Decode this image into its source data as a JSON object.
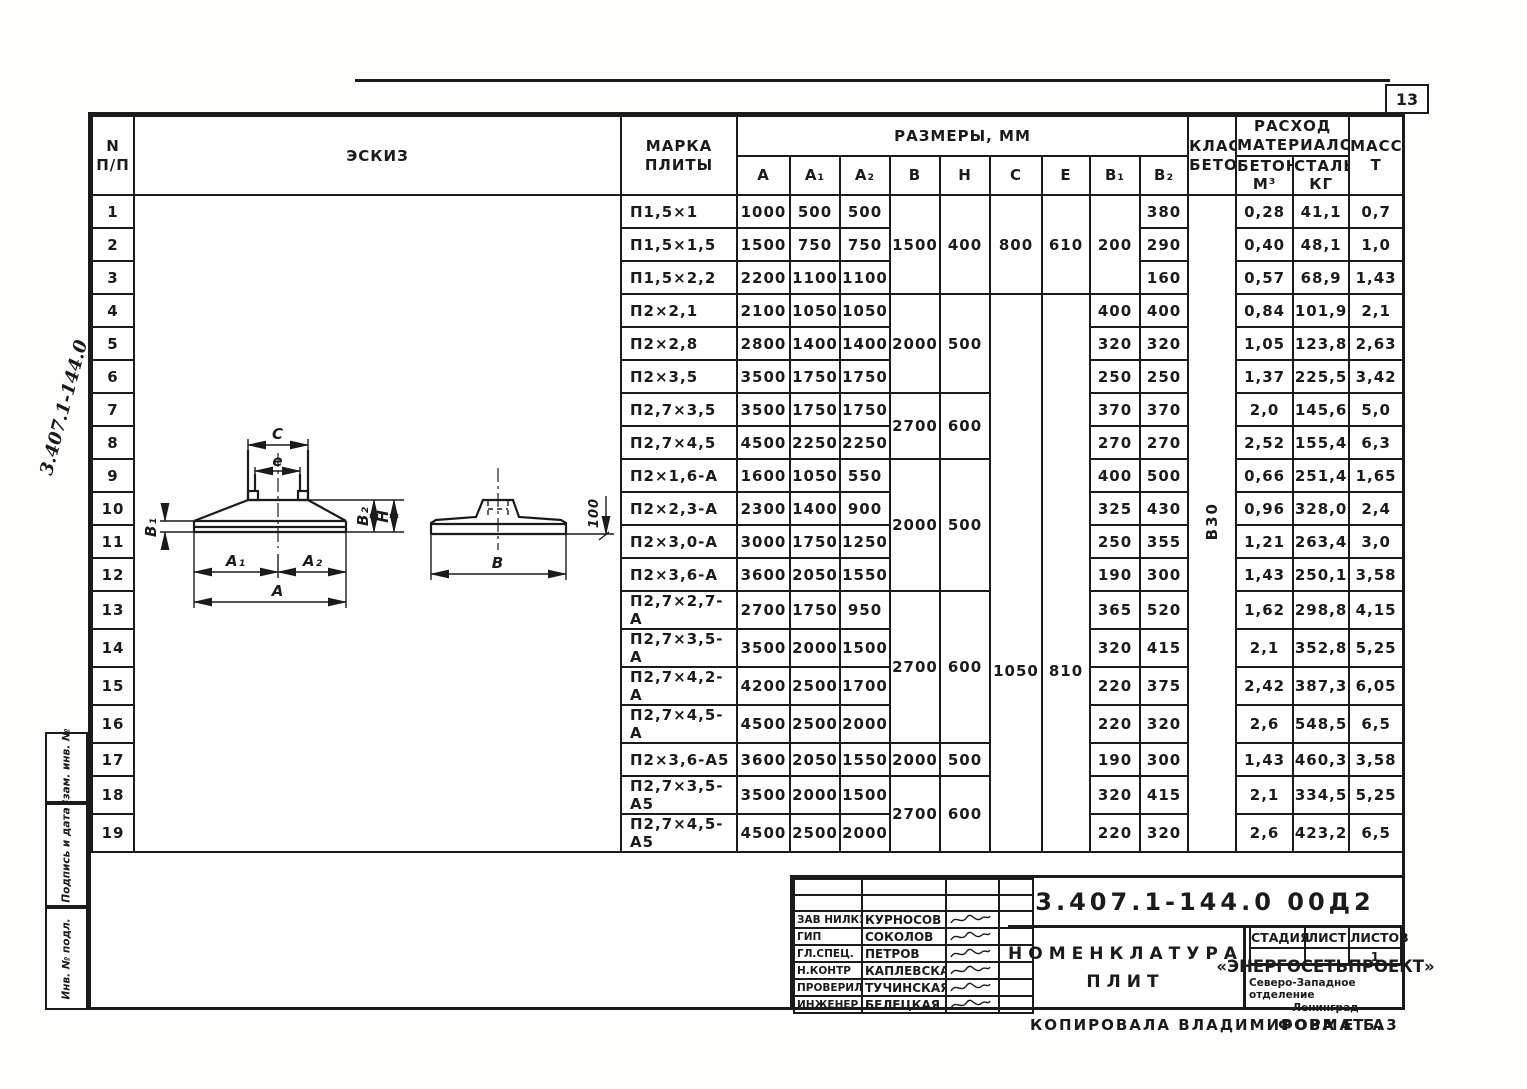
{
  "page_number": "13",
  "side_code": "3.407.1-144.0",
  "side_stamps": [
    "Взам. инв. №",
    "Подпись и дата",
    "Инв. № подл."
  ],
  "concrete_class": "В30",
  "table": {
    "headers": {
      "num": "N",
      "num2": "п/п",
      "sketch": "Эскиз",
      "mark": "Марка",
      "mark2": "плиты",
      "sizes": "Размеры, мм",
      "A": "А",
      "A1": "А₁",
      "A2": "А₂",
      "B": "В",
      "H": "Н",
      "C": "С",
      "e": "е",
      "B1": "В₁",
      "B2": "В₂",
      "cls": "Класс",
      "cls2": "бетона",
      "materials": "Расход",
      "materials2": "материалов",
      "concrete": "Бетон,",
      "concrete2": "м³",
      "steel": "Сталь,",
      "steel2": "кг",
      "mass": "Масса,",
      "mass2": "т"
    },
    "columns": [
      "num",
      "sk",
      "mark",
      "A",
      "A1",
      "A2",
      "B",
      "H",
      "C",
      "e",
      "B1",
      "B2",
      "cls",
      "concrete",
      "steel",
      "mass"
    ],
    "rows": [
      {
        "num": "1",
        "sk": {
          "slot": "sketch",
          "span": 19
        },
        "mark": "П1,5×1",
        "A": "1000",
        "A1": "500",
        "A2": "500",
        "B": {
          "v": "1500",
          "span": 3
        },
        "H": {
          "v": "400",
          "span": 3
        },
        "C": {
          "v": "800",
          "span": 3
        },
        "e": {
          "v": "610",
          "span": 3
        },
        "B1": {
          "v": "200",
          "span": 3
        },
        "B2": "380",
        "cls": {
          "v": "В30",
          "span": 19,
          "cls": "vert"
        },
        "concrete": "0,28",
        "steel": "41,1",
        "mass": "0,7"
      },
      {
        "num": "2",
        "mark": "П1,5×1,5",
        "A": "1500",
        "A1": "750",
        "A2": "750",
        "B2": "290",
        "concrete": "0,40",
        "steel": "48,1",
        "mass": "1,0"
      },
      {
        "num": "3",
        "mark": "П1,5×2,2",
        "A": "2200",
        "A1": "1100",
        "A2": "1100",
        "B2": "160",
        "concrete": "0,57",
        "steel": "68,9",
        "mass": "1,43"
      },
      {
        "num": "4",
        "mark": "П2×2,1",
        "A": "2100",
        "A1": "1050",
        "A2": "1050",
        "B": {
          "v": "2000",
          "span": 3
        },
        "H": {
          "v": "500",
          "span": 3
        },
        "C": {
          "v": "1050",
          "span": 16,
          "cls": "ce"
        },
        "e": {
          "v": "810",
          "span": 16,
          "cls": "ce"
        },
        "B1": "400",
        "B2": "400",
        "concrete": "0,84",
        "steel": "101,9",
        "mass": "2,1"
      },
      {
        "num": "5",
        "mark": "П2×2,8",
        "A": "2800",
        "A1": "1400",
        "A2": "1400",
        "B1": "320",
        "B2": "320",
        "concrete": "1,05",
        "steel": "123,8",
        "mass": "2,63"
      },
      {
        "num": "6",
        "mark": "П2×3,5",
        "A": "3500",
        "A1": "1750",
        "A2": "1750",
        "B1": "250",
        "B2": "250",
        "concrete": "1,37",
        "steel": "225,5",
        "mass": "3,42"
      },
      {
        "num": "7",
        "mark": "П2,7×3,5",
        "A": "3500",
        "A1": "1750",
        "A2": "1750",
        "B": {
          "v": "2700",
          "span": 2
        },
        "H": {
          "v": "600",
          "span": 2
        },
        "B1": "370",
        "B2": "370",
        "concrete": "2,0",
        "steel": "145,6",
        "mass": "5,0"
      },
      {
        "num": "8",
        "mark": "П2,7×4,5",
        "A": "4500",
        "A1": "2250",
        "A2": "2250",
        "B1": "270",
        "B2": "270",
        "concrete": "2,52",
        "steel": "155,4",
        "mass": "6,3"
      },
      {
        "num": "9",
        "mark": "П2×1,6-А",
        "A": "1600",
        "A1": "1050",
        "A2": "550",
        "B": {
          "v": "2000",
          "span": 4
        },
        "H": {
          "v": "500",
          "span": 4
        },
        "B1": "400",
        "B2": "500",
        "concrete": "0,66",
        "steel": "251,4",
        "mass": "1,65"
      },
      {
        "num": "10",
        "mark": "П2×2,3-А",
        "A": "2300",
        "A1": "1400",
        "A2": "900",
        "B1": "325",
        "B2": "430",
        "concrete": "0,96",
        "steel": "328,0",
        "mass": "2,4"
      },
      {
        "num": "11",
        "mark": "П2×3,0-А",
        "A": "3000",
        "A1": "1750",
        "A2": "1250",
        "B1": "250",
        "B2": "355",
        "concrete": "1,21",
        "steel": "263,4",
        "mass": "3,0"
      },
      {
        "num": "12",
        "mark": "П2×3,6-А",
        "A": "3600",
        "A1": "2050",
        "A2": "1550",
        "B1": "190",
        "B2": "300",
        "concrete": "1,43",
        "steel": "250,1",
        "mass": "3,58"
      },
      {
        "num": "13",
        "mark": "П2,7×2,7-А",
        "A": "2700",
        "A1": "1750",
        "A2": "950",
        "B": {
          "v": "2700",
          "span": 4
        },
        "H": {
          "v": "600",
          "span": 4
        },
        "B1": "365",
        "B2": "520",
        "concrete": "1,62",
        "steel": "298,8",
        "mass": "4,15"
      },
      {
        "num": "14",
        "mark": "П2,7×3,5-А",
        "A": "3500",
        "A1": "2000",
        "A2": "1500",
        "B1": "320",
        "B2": "415",
        "concrete": "2,1",
        "steel": "352,8",
        "mass": "5,25"
      },
      {
        "num": "15",
        "mark": "П2,7×4,2-А",
        "A": "4200",
        "A1": "2500",
        "A2": "1700",
        "B1": "220",
        "B2": "375",
        "concrete": "2,42",
        "steel": "387,3",
        "mass": "6,05"
      },
      {
        "num": "16",
        "mark": "П2,7×4,5-А",
        "A": "4500",
        "A1": "2500",
        "A2": "2000",
        "B1": "220",
        "B2": "320",
        "concrete": "2,6",
        "steel": "548,5",
        "mass": "6,5"
      },
      {
        "num": "17",
        "mark": "П2×3,6-А5",
        "A": "3600",
        "A1": "2050",
        "A2": "1550",
        "B": "2000",
        "H": "500",
        "B1": "190",
        "B2": "300",
        "concrete": "1,43",
        "steel": "460,3",
        "mass": "3,58"
      },
      {
        "num": "18",
        "mark": "П2,7×3,5-А5",
        "A": "3500",
        "A1": "2000",
        "A2": "1500",
        "B": {
          "v": "2700",
          "span": 2
        },
        "H": {
          "v": "600",
          "span": 2
        },
        "B1": "320",
        "B2": "415",
        "concrete": "2,1",
        "steel": "334,5",
        "mass": "5,25"
      },
      {
        "num": "19",
        "mark": "П2,7×4,5-А5",
        "A": "4500",
        "A1": "2500",
        "A2": "2000",
        "B1": "220",
        "B2": "320",
        "concrete": "2,6",
        "steel": "423,2",
        "mass": "6,5"
      }
    ]
  },
  "sketch": {
    "labels": {
      "C": "С",
      "e": "е",
      "B1": "В₁",
      "B2": "В₂",
      "H": "Н",
      "A1": "А₁",
      "A2": "А₂",
      "A": "А",
      "B": "В",
      "d100": "100"
    }
  },
  "title_block": {
    "doc_number": "3.407.1-144.0  00Д2",
    "title_line1": "Номенклатура",
    "title_line2": "плит",
    "stage_label": "Стадия",
    "sheet_label": "Лист",
    "sheets_label": "Листов",
    "stage_value": "",
    "sheet_value": "",
    "sheets_value": "1",
    "org_name": "«ЭНЕРГОСЕТЬПРОЕКТ»",
    "org_branch": "Северо-Западное отделение",
    "org_city": "Ленинград",
    "personnel": [
      {
        "role": "Зав НИЛКЭ",
        "name": "Курносов"
      },
      {
        "role": "ГИП",
        "name": "Соколов"
      },
      {
        "role": "Гл.спец.",
        "name": "Петров"
      },
      {
        "role": "Н.контр",
        "name": "Каплевская"
      },
      {
        "role": "Проверил",
        "name": "Тучинская"
      },
      {
        "role": "Инженер",
        "name": "Белецкая"
      }
    ],
    "copied_by": "Копировала Владимирова Е.Б.",
    "format": "Формат А3"
  }
}
